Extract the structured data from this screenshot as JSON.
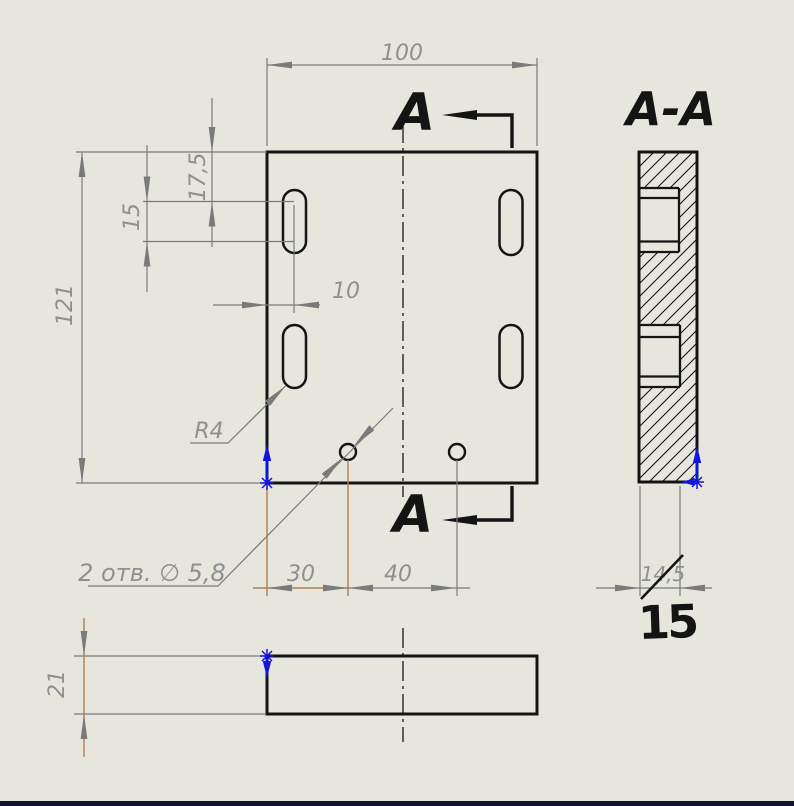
{
  "canvas": {
    "background": "#e7e6dd",
    "window_edge_color": "#12122e"
  },
  "colors": {
    "geometry": "#141414",
    "dimension_lines": "#7a7a7a",
    "dimension_text": "#8f8f8f",
    "selected_highlight": "#ae7f51",
    "origin_marker_blue": "#1414e0"
  },
  "section": {
    "cut_label_top": "A",
    "cut_label_bottom": "A",
    "view_title": "A-A"
  },
  "dims": {
    "overall_width": "100",
    "overall_height": "121",
    "slot_top_offset": "17,5",
    "slot_center_distance": "15",
    "slot_edge_offset": "10",
    "slot_radius": "R4",
    "holes_note": "2 отв. ∅ 5,8",
    "hole_offset": "30",
    "hole_spacing": "40",
    "plate_thickness": "21",
    "pocket_depth_old": "14,5",
    "pocket_depth_marked": "15"
  }
}
